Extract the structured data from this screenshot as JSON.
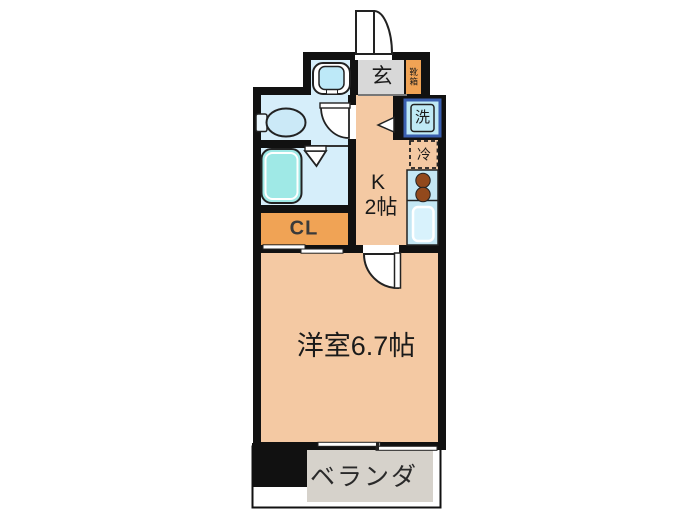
{
  "floor_plan": {
    "type": "japanese-apartment-1K-floor-plan",
    "rooms": {
      "genkan": {
        "label": "玄"
      },
      "shoe_box": {
        "label": "靴箱"
      },
      "washer": {
        "label": "洗"
      },
      "fridge": {
        "label": "冷"
      },
      "kitchen": {
        "label_line1": "K",
        "label_line2": "2帖"
      },
      "closet": {
        "label": "CL"
      },
      "western_room": {
        "label": "洋室6.7帖"
      },
      "veranda": {
        "label": "ベランダ"
      }
    },
    "colors": {
      "wall": "#111111",
      "room_peach": "#F4C9A3",
      "closet_orange": "#F0A355",
      "wet_room_blue": "#D6EEFA",
      "fixture_blue": "#BDE9F8",
      "bathtub_cyan": "#9FE9E6",
      "counter_blue": "#C4E7F4",
      "burner_brown": "#92491C",
      "washer_border_blue": "#3A5FB0",
      "genkan_gray": "#D8D8D8",
      "veranda_gray": "#D6D2CB"
    }
  }
}
